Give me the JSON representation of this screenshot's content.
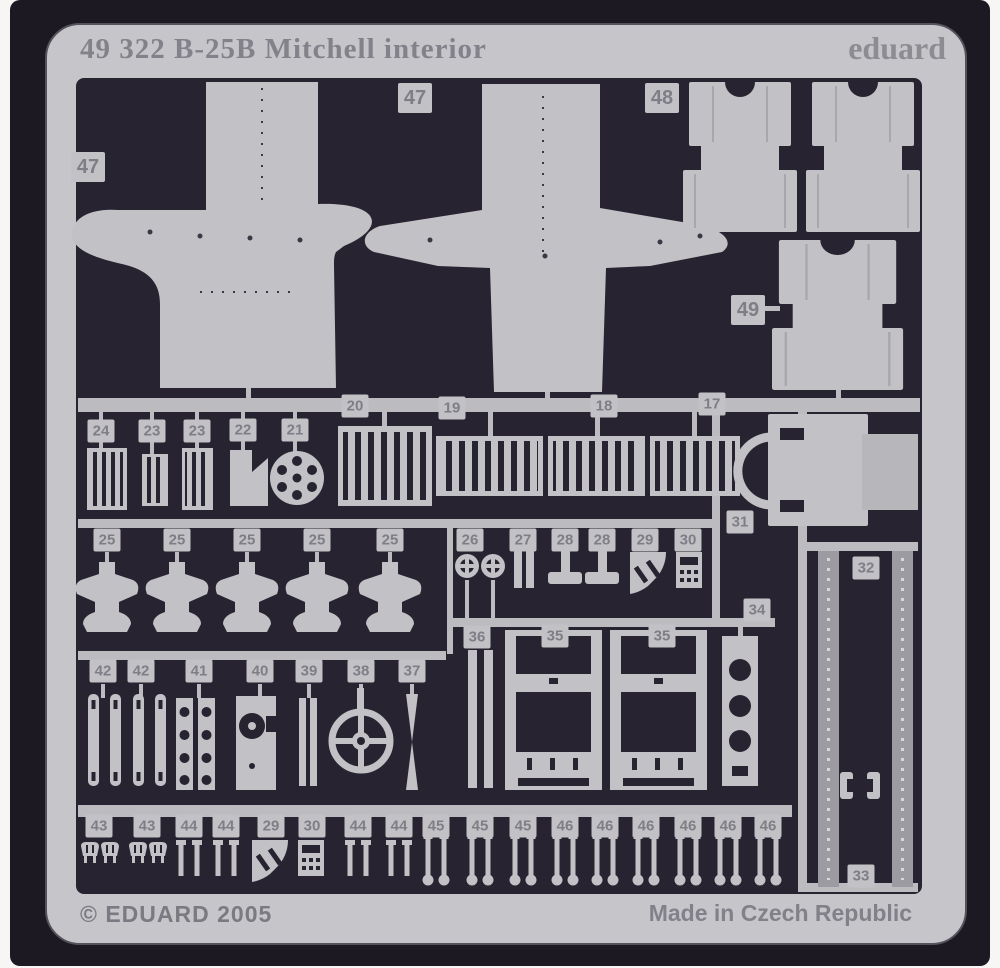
{
  "photo": {
    "plate_title": "49 322  B-25B Mitchell interior",
    "brand": "eduard",
    "footer_left": "© EDUARD 2005",
    "footer_right": "Made in Czech Republic",
    "colors": {
      "frame": "#c6c5c9",
      "background": "#282330",
      "metal": "#c2c1c5",
      "strap": "#9c9ba1",
      "tag_text": "#7f7e86"
    },
    "part_tags": [
      {
        "label": "47",
        "x": 88,
        "y": 167,
        "size": "lg"
      },
      {
        "label": "47",
        "x": 415,
        "y": 98,
        "size": "lg"
      },
      {
        "label": "48",
        "x": 662,
        "y": 98,
        "size": "lg"
      },
      {
        "label": "49",
        "x": 748,
        "y": 310,
        "size": "lg"
      },
      {
        "label": "20",
        "x": 355,
        "y": 406
      },
      {
        "label": "19",
        "x": 452,
        "y": 408
      },
      {
        "label": "18",
        "x": 604,
        "y": 406
      },
      {
        "label": "17",
        "x": 712,
        "y": 404
      },
      {
        "label": "24",
        "x": 101,
        "y": 431
      },
      {
        "label": "23",
        "x": 152,
        "y": 431
      },
      {
        "label": "23",
        "x": 197,
        "y": 431
      },
      {
        "label": "22",
        "x": 243,
        "y": 430
      },
      {
        "label": "21",
        "x": 295,
        "y": 430
      },
      {
        "label": "31",
        "x": 740,
        "y": 522
      },
      {
        "label": "25",
        "x": 107,
        "y": 540
      },
      {
        "label": "25",
        "x": 177,
        "y": 540
      },
      {
        "label": "25",
        "x": 247,
        "y": 540
      },
      {
        "label": "25",
        "x": 317,
        "y": 540
      },
      {
        "label": "25",
        "x": 390,
        "y": 540
      },
      {
        "label": "26",
        "x": 470,
        "y": 540
      },
      {
        "label": "27",
        "x": 523,
        "y": 540
      },
      {
        "label": "28",
        "x": 565,
        "y": 540
      },
      {
        "label": "28",
        "x": 602,
        "y": 540
      },
      {
        "label": "29",
        "x": 645,
        "y": 540
      },
      {
        "label": "30",
        "x": 688,
        "y": 540
      },
      {
        "label": "32",
        "x": 866,
        "y": 568
      },
      {
        "label": "34",
        "x": 757,
        "y": 610
      },
      {
        "label": "36",
        "x": 477,
        "y": 637
      },
      {
        "label": "35",
        "x": 555,
        "y": 636
      },
      {
        "label": "35",
        "x": 662,
        "y": 636
      },
      {
        "label": "42",
        "x": 103,
        "y": 671
      },
      {
        "label": "42",
        "x": 141,
        "y": 671
      },
      {
        "label": "41",
        "x": 199,
        "y": 671
      },
      {
        "label": "40",
        "x": 260,
        "y": 671
      },
      {
        "label": "39",
        "x": 309,
        "y": 671
      },
      {
        "label": "38",
        "x": 361,
        "y": 671
      },
      {
        "label": "37",
        "x": 412,
        "y": 671
      },
      {
        "label": "43",
        "x": 99,
        "y": 826
      },
      {
        "label": "43",
        "x": 147,
        "y": 826
      },
      {
        "label": "44",
        "x": 189,
        "y": 826
      },
      {
        "label": "44",
        "x": 226,
        "y": 826
      },
      {
        "label": "29",
        "x": 271,
        "y": 826
      },
      {
        "label": "30",
        "x": 312,
        "y": 826
      },
      {
        "label": "44",
        "x": 358,
        "y": 826
      },
      {
        "label": "44",
        "x": 399,
        "y": 826
      },
      {
        "label": "45",
        "x": 436,
        "y": 826
      },
      {
        "label": "45",
        "x": 480,
        "y": 826
      },
      {
        "label": "45",
        "x": 523,
        "y": 826
      },
      {
        "label": "46",
        "x": 565,
        "y": 826
      },
      {
        "label": "46",
        "x": 605,
        "y": 826
      },
      {
        "label": "46",
        "x": 646,
        "y": 826
      },
      {
        "label": "46",
        "x": 688,
        "y": 826
      },
      {
        "label": "46",
        "x": 728,
        "y": 826
      },
      {
        "label": "46",
        "x": 768,
        "y": 826
      },
      {
        "label": "33",
        "x": 861,
        "y": 876
      }
    ]
  }
}
